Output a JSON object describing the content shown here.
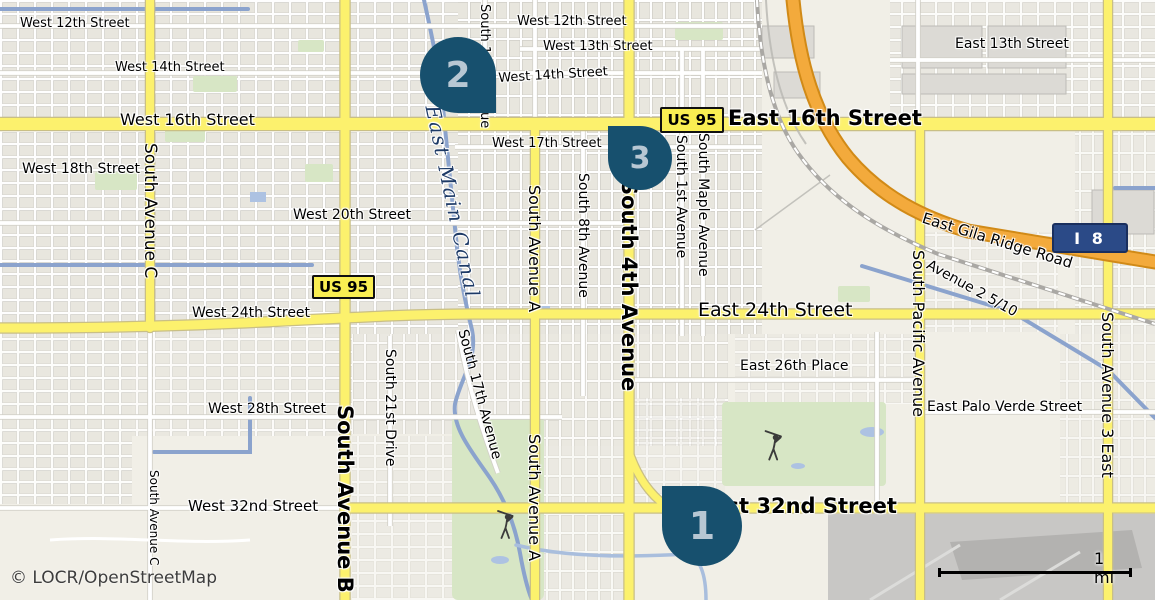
{
  "map": {
    "attribution": "© LOCR/OpenStreetMap",
    "scale_bar": {
      "label": "1 mi"
    },
    "colors": {
      "background": "#f1efe7",
      "major_road_yellow": "#fcf16d",
      "motorway_orange": "#f3aa3c",
      "canal_blue": "#8ba3cd",
      "park_green": "#d7e6c5",
      "marker_fill": "#17506e",
      "marker_number": "#b7c7d3",
      "us_shield_bg": "#f9ee52",
      "interstate_shield_bg": "#2b4a87",
      "canal_label_text": "#1d3a66"
    },
    "shields": [
      {
        "n": "route-shield-us95-west",
        "type": "us",
        "label": "US 95",
        "x": 312,
        "y": 275,
        "w": 63,
        "h": 24
      },
      {
        "n": "route-shield-us95-east",
        "type": "us",
        "label": "US 95",
        "x": 660,
        "y": 107,
        "w": 64,
        "h": 26
      },
      {
        "n": "route-shield-i8",
        "type": "interstate",
        "label": "I 8",
        "x": 1052,
        "y": 223,
        "w": 76,
        "h": 30
      }
    ],
    "markers": [
      {
        "n": "map-marker-1",
        "label": "1",
        "x": 662,
        "y": 486,
        "size": 80,
        "tip": "top-left"
      },
      {
        "n": "map-marker-2",
        "label": "2",
        "x": 420,
        "y": 37,
        "size": 76,
        "tip": "bottom-right"
      },
      {
        "n": "map-marker-3",
        "label": "3",
        "x": 608,
        "y": 126,
        "size": 64,
        "tip": "top-left"
      }
    ],
    "street_labels": [
      {
        "n": "label-west-12th-street",
        "t": "West 12th Street",
        "x": 20,
        "y": 25,
        "s": 13
      },
      {
        "n": "label-west-12th-street-2",
        "t": "West 12th Street",
        "x": 517,
        "y": 23,
        "s": 13
      },
      {
        "n": "label-west-13th-street",
        "t": "West 13th Street",
        "x": 543,
        "y": 48,
        "s": 13
      },
      {
        "n": "label-west-14th-street",
        "t": "West 14th Street",
        "x": 115,
        "y": 69,
        "s": 13
      },
      {
        "n": "label-west-14th-street-2",
        "t": "West 14th Street",
        "x": 498,
        "y": 72,
        "s": 13,
        "r": -3.5
      },
      {
        "n": "label-west-16th-street",
        "t": "West 16th Street",
        "x": 120,
        "y": 121,
        "s": 16
      },
      {
        "n": "label-east-16th-street",
        "t": "East 16th Street",
        "x": 728,
        "y": 120,
        "s": 21,
        "b": 1
      },
      {
        "n": "label-east-13th-street",
        "t": "East 13th Street",
        "x": 955,
        "y": 46,
        "s": 14
      },
      {
        "n": "label-west-17th-street",
        "t": "West 17th Street",
        "x": 492,
        "y": 145,
        "s": 13
      },
      {
        "n": "label-west-18th-street",
        "t": "West 18th Street",
        "x": 22,
        "y": 171,
        "s": 14
      },
      {
        "n": "label-west-20th-street",
        "t": "West 20th Street",
        "x": 293,
        "y": 217,
        "s": 14
      },
      {
        "n": "label-west-24th-street",
        "t": "West 24th Street",
        "x": 192,
        "y": 315,
        "s": 14
      },
      {
        "n": "label-east-24th-street",
        "t": "East 24th Street",
        "x": 698,
        "y": 312,
        "s": 19
      },
      {
        "n": "label-east-26th-place",
        "t": "East 26th Place",
        "x": 740,
        "y": 368,
        "s": 14
      },
      {
        "n": "label-west-28th-street",
        "t": "West 28th Street",
        "x": 208,
        "y": 411,
        "s": 14
      },
      {
        "n": "label-east-palo-verde-street",
        "t": "East Palo Verde Street",
        "x": 927,
        "y": 409,
        "s": 14
      },
      {
        "n": "label-west-32nd-street",
        "t": "West 32nd Street",
        "x": 188,
        "y": 507,
        "s": 15
      },
      {
        "n": "label-east-32nd-street",
        "t": "East 32nd Street",
        "x": 698,
        "y": 508,
        "s": 21,
        "b": 1
      },
      {
        "n": "label-east-gila-ridge-road",
        "t": "East Gila Ridge Road",
        "x": 925,
        "y": 210,
        "s": 15,
        "r": 17
      },
      {
        "n": "label-avenue-2-5-10",
        "t": "Avenue 2 5/10",
        "x": 931,
        "y": 258,
        "s": 14,
        "r": 29
      },
      {
        "n": "label-south-avenue-c",
        "t": "South Avenue C",
        "x": 159,
        "y": 143,
        "s": 17,
        "r": 90
      },
      {
        "n": "label-south-avenue-c-2",
        "t": "South Avenue C",
        "x": 160,
        "y": 470,
        "s": 12,
        "r": 90
      },
      {
        "n": "label-south-avenue-b",
        "t": "South Avenue B",
        "x": 356,
        "y": 405,
        "s": 21,
        "b": 1,
        "r": 90
      },
      {
        "n": "label-south-21st-drive",
        "t": "South 21st Drive",
        "x": 397,
        "y": 349,
        "s": 14,
        "r": 90
      },
      {
        "n": "label-south-17th-avenue",
        "t": "South 17th Avenue",
        "x": 469,
        "y": 328,
        "s": 14,
        "r": 75
      },
      {
        "n": "label-south-avenue-a",
        "t": "South Avenue A",
        "x": 543,
        "y": 185,
        "s": 16,
        "r": 90
      },
      {
        "n": "label-south-avenue-a-2",
        "t": "South Avenue A",
        "x": 543,
        "y": 434,
        "s": 16,
        "r": 90
      },
      {
        "n": "label-south-8th-avenue",
        "t": "South 8th Avenue",
        "x": 590,
        "y": 173,
        "s": 14,
        "r": 90
      },
      {
        "n": "label-south-4th-avenue",
        "t": "South 4th Avenue",
        "x": 640,
        "y": 180,
        "s": 21,
        "b": 1,
        "r": 90
      },
      {
        "n": "label-south-1st-avenue",
        "t": "South 1st Avenue",
        "x": 688,
        "y": 135,
        "s": 14,
        "r": 90
      },
      {
        "n": "label-south-maple-avenue",
        "t": "South Maple Avenue",
        "x": 710,
        "y": 133,
        "s": 14,
        "r": 90
      },
      {
        "n": "label-south-14th-avenue",
        "t": "South 14th Avenue",
        "x": 491,
        "y": 4,
        "s": 13,
        "r": 90
      },
      {
        "n": "label-south-pacific-avenue",
        "t": "South Pacific Avenue",
        "x": 927,
        "y": 250,
        "s": 16,
        "r": 90
      },
      {
        "n": "label-south-avenue-3-east",
        "t": "South Avenue 3 East",
        "x": 1116,
        "y": 312,
        "s": 16,
        "r": 90
      }
    ],
    "waterway_labels": [
      {
        "n": "label-east-main-canal",
        "t": "East Main Canal",
        "x": 443,
        "y": 103,
        "s": 20,
        "r": 78,
        "it": 1,
        "c": "#1d3a66",
        "ls": 2
      }
    ],
    "icons": [
      {
        "name": "golfer-icon",
        "x": 506,
        "y": 528
      },
      {
        "name": "golfer-icon",
        "x": 774,
        "y": 449
      }
    ]
  }
}
